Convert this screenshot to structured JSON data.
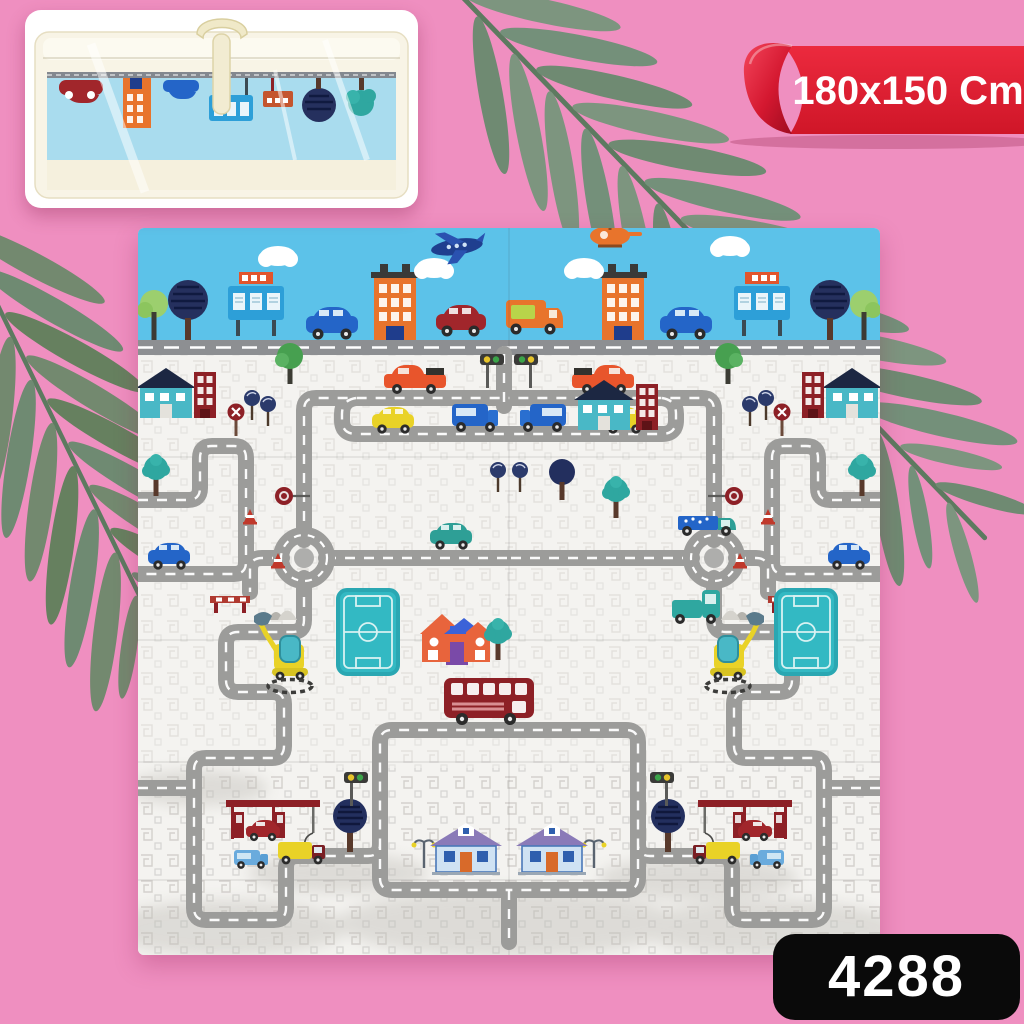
{
  "page": {
    "background_color": "#ef8fc0"
  },
  "size_ribbon": {
    "label": "180x150 Cm",
    "ribbon_color": "#e11f31",
    "curl_color": "#b8122a",
    "text_color": "#ffffff"
  },
  "product_badge": {
    "code": "4288",
    "bg_color": "#0a0a0a",
    "text_color": "#ffffff"
  },
  "inset_photo": {
    "subject": "folded-play-mat-in-clear-carry-bag",
    "bag_color": "#f8f4e6",
    "handle_color": "#f0e9c8",
    "mat_band_color": "#a9dcee",
    "band_road_color": "#83888f",
    "motifs": [
      "red-car",
      "orange-building",
      "blue-car",
      "billboard",
      "small-billboard",
      "navy-tree",
      "teal-tree"
    ]
  },
  "decor": {
    "palm_leaf_color": "#7d957f",
    "palm_leaf_alt_color": "#6f8a72",
    "palm_stem_color": "#5d7a60"
  },
  "play_mat": {
    "sky_color": "#5cc2e9",
    "ground_color": "#f4f3f0",
    "road_color": "#9c9c9a",
    "road_line_color": "#ffffff",
    "field_color": "#33b9c3",
    "bus_color": "#8d2026",
    "elements": [
      "airplane",
      "helicopter",
      "clouds",
      "billboards",
      "city-buildings",
      "sky-cars",
      "orange-van",
      "road-strip",
      "road-network",
      "roundabouts",
      "stop-signs",
      "traffic-lights",
      "lollipop-trees",
      "navy-trees",
      "teal-trees",
      "green-trees",
      "pickup-trucks",
      "yellow-car",
      "blue-cars",
      "teal-car",
      "blue-vans",
      "crate-truck",
      "teal-truck",
      "double-decker-bus",
      "soccer-fields",
      "orange-house",
      "teal-houses",
      "brick-buildings",
      "blue-houses",
      "gas-stations",
      "fuel-trucks",
      "red-cars",
      "excavators",
      "traffic-cones",
      "road-barriers",
      "mountains",
      "street-lamps"
    ]
  }
}
